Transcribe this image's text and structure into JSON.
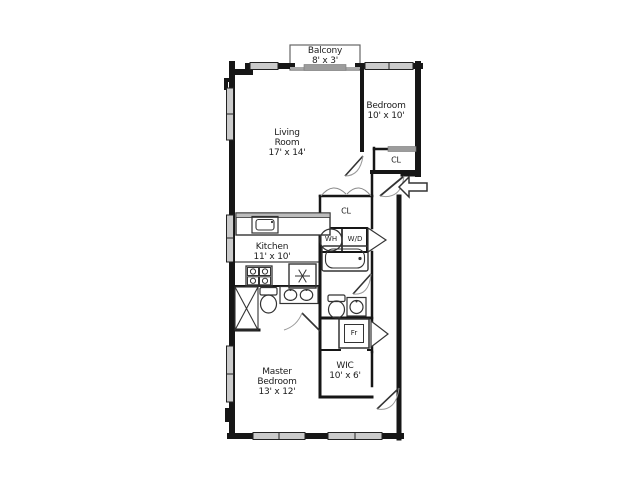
{
  "plan": {
    "type": "apartment-floor-plan",
    "rooms": {
      "balcony": {
        "name": "Balcony",
        "dims": "8' x 3'"
      },
      "bedroom": {
        "name": "Bedroom",
        "dims": "10' x 10'"
      },
      "living_room": {
        "name": "Living\nRoom",
        "dims": "17' x 14'"
      },
      "kitchen": {
        "name": "Kitchen",
        "dims": "11' x 10'"
      },
      "wic": {
        "name": "WIC",
        "dims": "10' x 6'"
      },
      "master_bedroom": {
        "name": "Master\nBedroom",
        "dims": "13' x 12'"
      }
    },
    "labels": {
      "closet_bedroom": "CL",
      "closet_hall": "CL",
      "water_heater": "WH",
      "washer_dryer": "W/D",
      "fridge_cabinet": "Fr"
    },
    "fixtures": [
      "kitchen-island-sink",
      "stove-4-burner",
      "refrigerator-snowflake",
      "shower-x-stall",
      "toilet",
      "double-vanity-sinks",
      "bathtub",
      "toilet-second",
      "single-sink",
      "entry-arrow",
      "door-swings",
      "windows"
    ],
    "colors": {
      "wall": "#161616",
      "window_fill": "#cbcbcb",
      "fixture_stroke": "#333333",
      "door_arc": "#999999",
      "background": "#ffffff"
    }
  }
}
